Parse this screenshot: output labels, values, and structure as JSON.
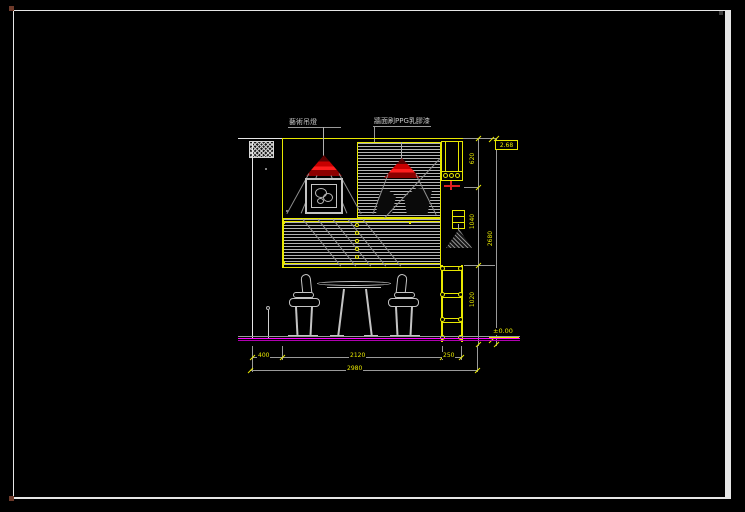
{
  "annotations": {
    "pendant_label": "藝術吊燈",
    "wall_finish_label": "牆面刷PPG乳膠漆"
  },
  "levels": {
    "top_level": "2.68",
    "floor_level": "±0.00"
  },
  "dims": {
    "v": [
      "620",
      "1040",
      "1020"
    ],
    "v_overall": "2680",
    "h": [
      "400",
      "2120",
      "250"
    ],
    "h_overall": "2980"
  },
  "colors": {
    "background": "#000000",
    "sheet_frame": "#f0f0f0",
    "cad_yellow": "#e8e800",
    "cad_gray": "#9a9a9a",
    "cad_white": "#e6e6e6",
    "lamp_red": "#dd1111",
    "lamp_red_dark": "#6e0000",
    "floor_magenta": "#ff00ff"
  }
}
